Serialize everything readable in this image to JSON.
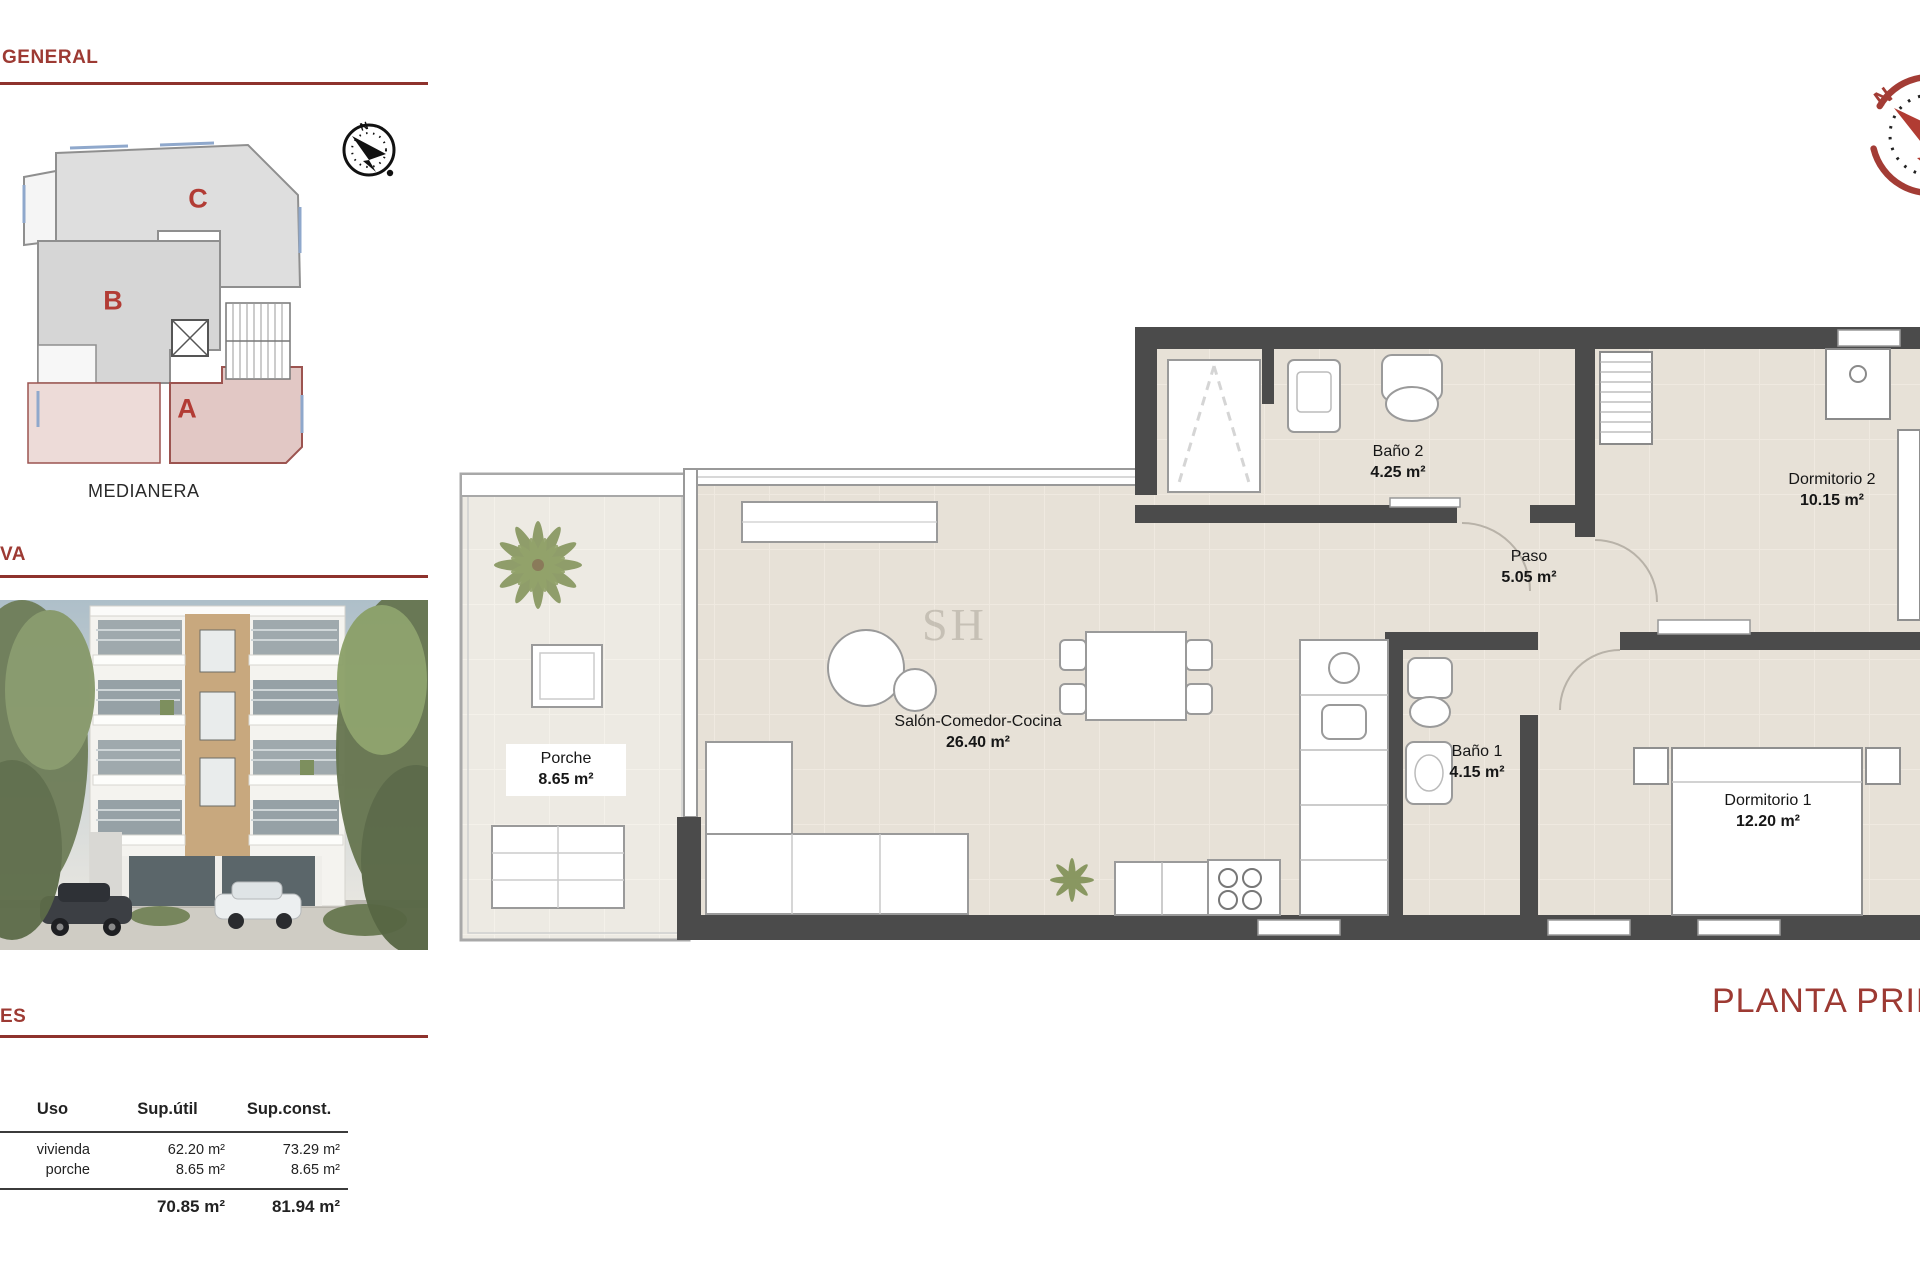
{
  "sections": {
    "general": {
      "title": "GENERAL"
    },
    "view": {
      "title": "VA"
    },
    "areas": {
      "title": "ES"
    }
  },
  "site_plan": {
    "blocks": [
      {
        "label": "C"
      },
      {
        "label": "B"
      },
      {
        "label": "A"
      }
    ],
    "highlight_block": "A",
    "boundary_label": "MEDIANERA",
    "compass_label": "N"
  },
  "floor_plan": {
    "title": "PLANTA PRIME",
    "watermark": "SH",
    "compass_label": "N",
    "rooms": [
      {
        "name": "Porche",
        "area": "8.65 m²"
      },
      {
        "name": "Salón-Comedor-Cocina",
        "area": "26.40 m²"
      },
      {
        "name": "Baño 2",
        "area": "4.25 m²"
      },
      {
        "name": "Paso",
        "area": "5.05 m²"
      },
      {
        "name": "Dormitorio 2",
        "area": "10.15 m²"
      },
      {
        "name": "Baño 1",
        "area": "4.15 m²"
      },
      {
        "name": "Dormitorio 1",
        "area": "12.20 m²"
      }
    ]
  },
  "surface_table": {
    "headers": [
      "Uso",
      "Sup.útil",
      "Sup.const."
    ],
    "rows": [
      {
        "uso": "vivienda",
        "util": "62.20 m²",
        "const": "73.29 m²"
      },
      {
        "uso": "porche",
        "util": "8.65 m²",
        "const": "8.65 m²"
      }
    ],
    "total": {
      "util": "70.85 m²",
      "const": "81.94 m²"
    }
  },
  "colors": {
    "accent_red": "#9d3a33",
    "wall_gray": "#4b4b4b",
    "floor_beige": "#e7e1d7",
    "highlight_pink": "#e2c8c5"
  }
}
